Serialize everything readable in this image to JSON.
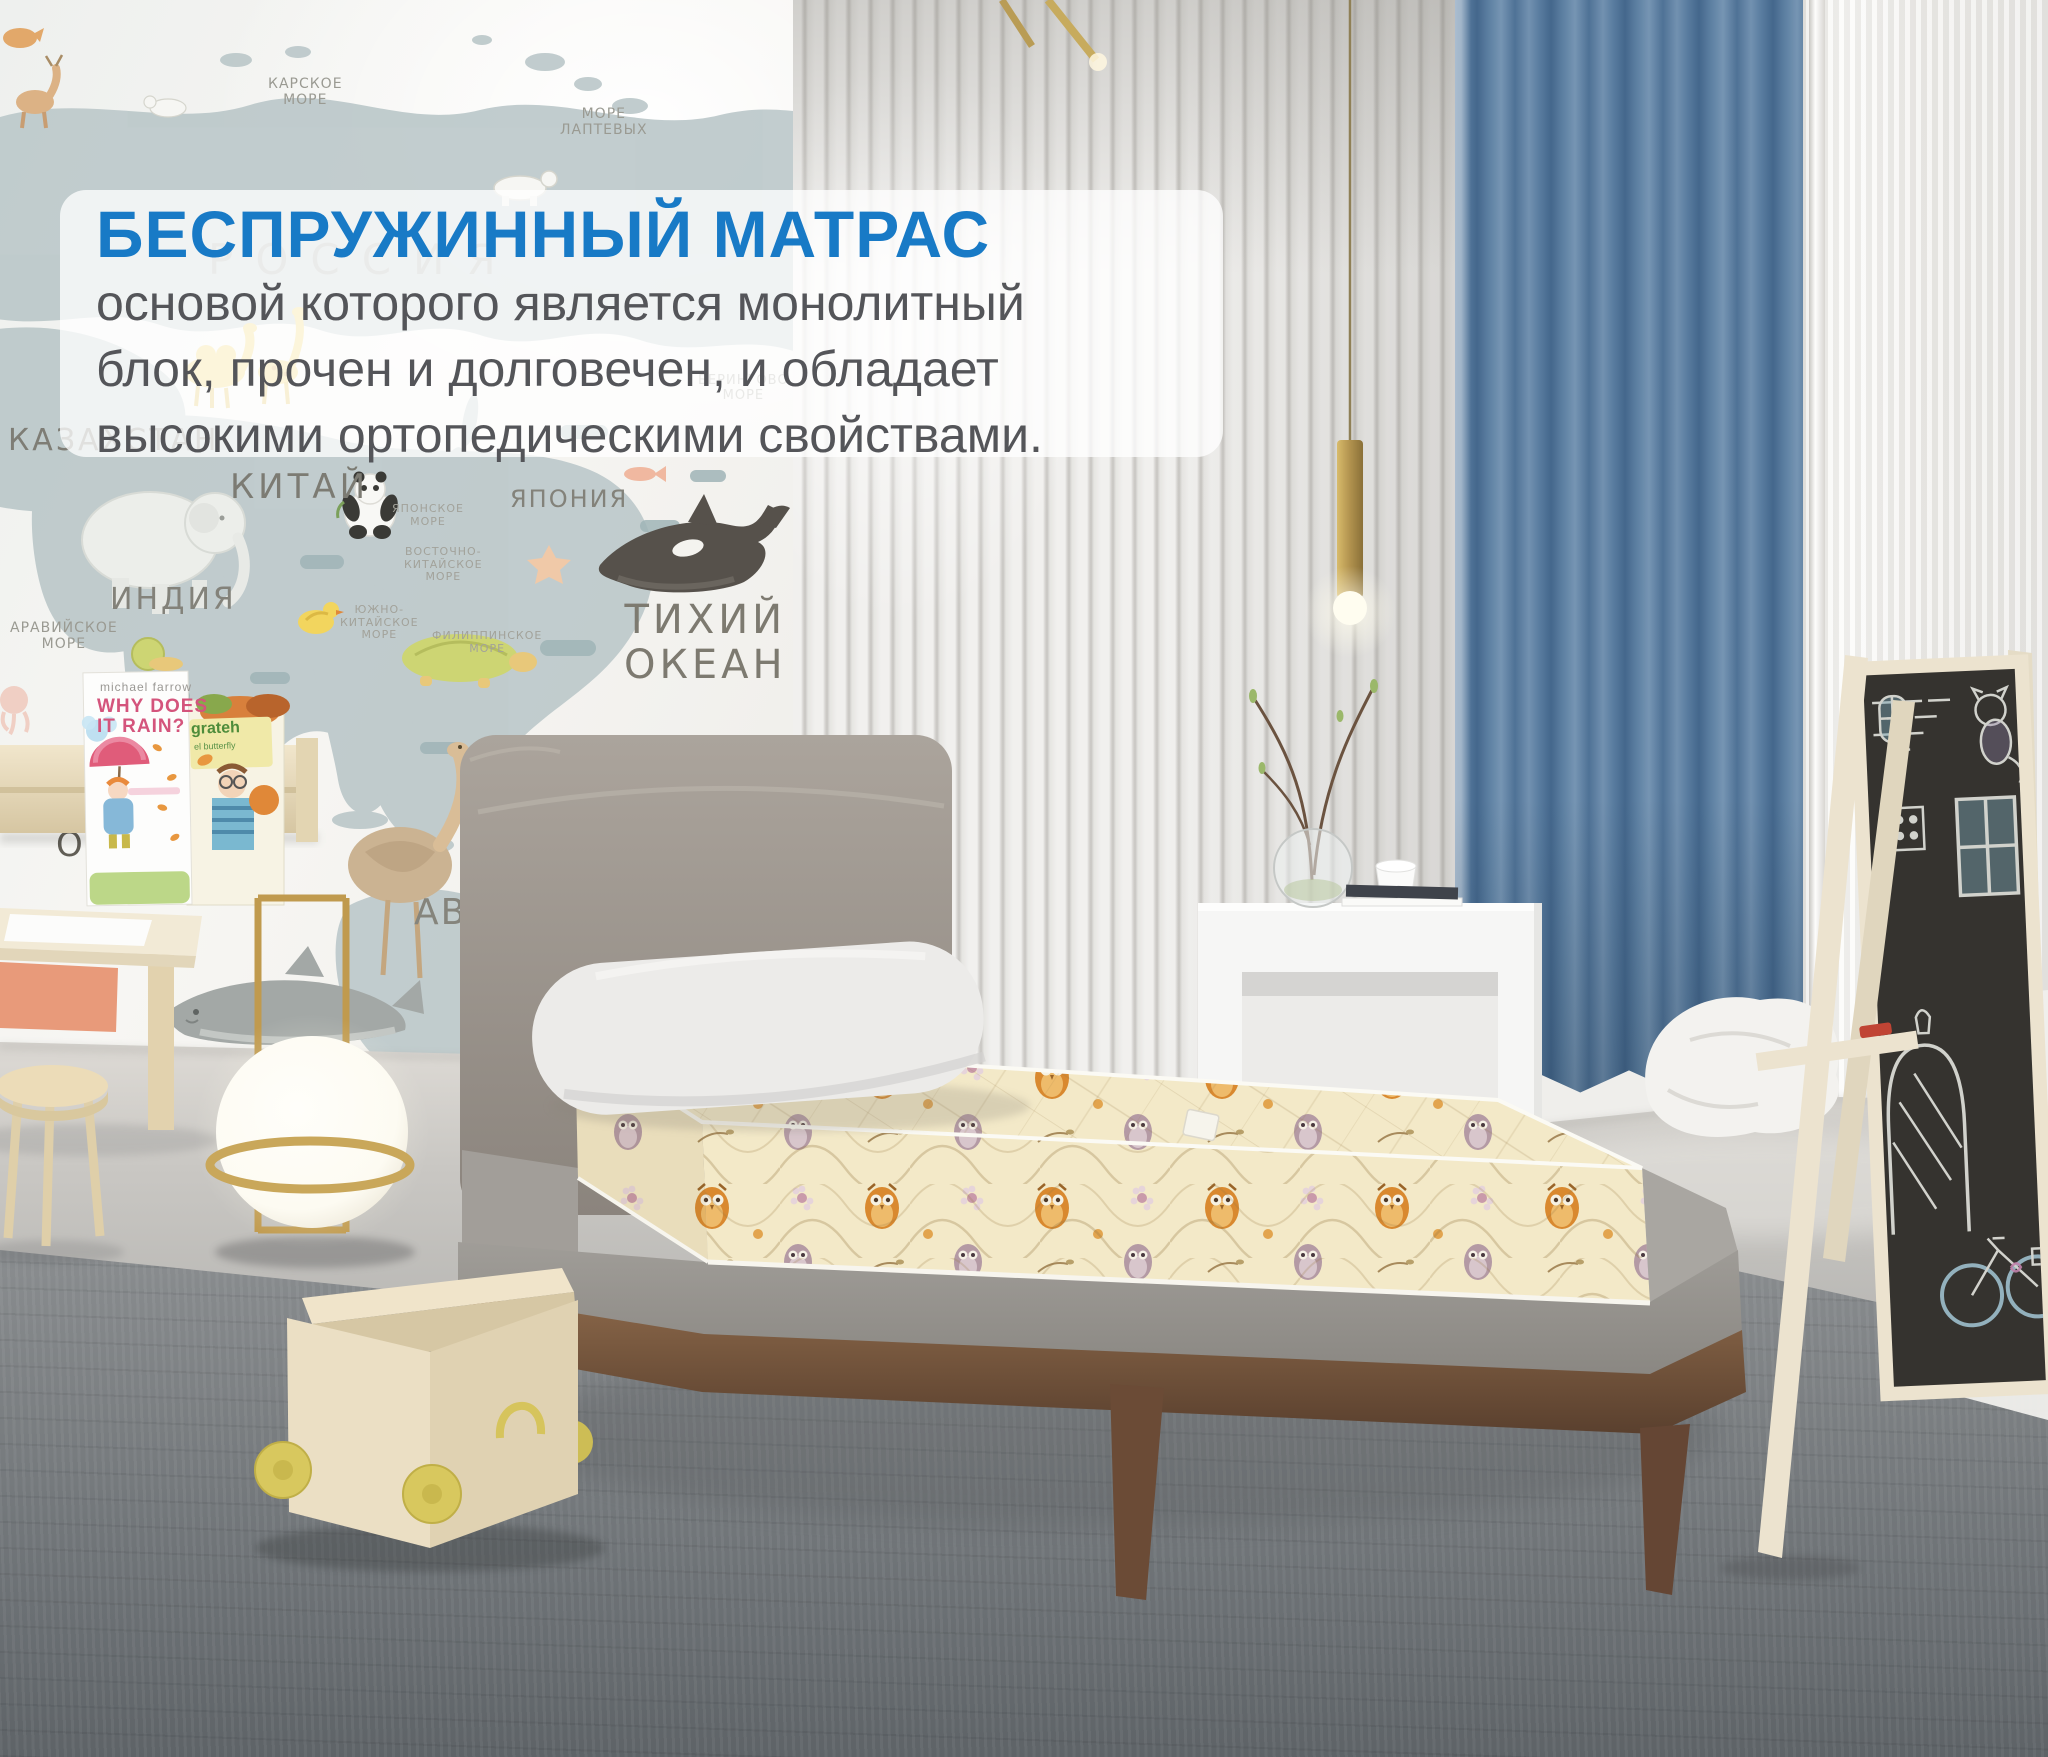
{
  "banner": {
    "title": "БЕСПРУЖИННЫЙ МАТРАС",
    "line1": "основой которого является монолитный",
    "line2": "блок, прочен и долговечен, и обладает",
    "line3": "высокими ортопедическими свойствами.",
    "title_color": "#187ac6",
    "text_color": "#545559",
    "background": "rgba(255,255,255,0.76)"
  },
  "map": {
    "labels": {
      "kara_sea": "КАРСКОЕ\nМОРЕ",
      "laptev_sea": "МОРЕ\nЛАПТЕВЫХ",
      "bering_sea": "БЕРИНГОВО\nМОРЕ",
      "russia": "РОССИЯ",
      "kazakhstan": "КАЗАХСТАН",
      "china": "КИТАЙ",
      "india": "ИНДИЯ",
      "japan": "ЯПОНИЯ",
      "japan_sea": "ЯПОНСКОЕ\nМОРЕ",
      "east_china_sea": "ВОСТОЧНО-\nКИТАЙСКОЕ\nМОРЕ",
      "south_china_sea": "ЮЖНО-\nКИТАЙСКОЕ\nМОРЕ",
      "philippine_sea": "ФИЛИППИНСКОЕ\nМОРЕ",
      "arabian_sea": "АРАВИЙСКОЕ\nМОРЕ",
      "pacific_ocean": "ТИХИЙ\nОКЕАН",
      "indian": "ИНДИЙСКИЙ",
      "ocean": "ОКЕАН",
      "australia": "АВСТРАЛИЯ"
    }
  },
  "books": {
    "book1_author": "michael farrow",
    "book1_title": "WHY DOES\nIT RAIN?",
    "book2_title": "grateh",
    "book2_subtitle": "el butterfly"
  },
  "colors": {
    "accent_blue": "#187ac6",
    "curtain_blue": "#5d80a2",
    "mattress_cream": "#f3e9c8",
    "owl_orange": "#d9892f",
    "bed_wood": "#6b4b36",
    "brass_gold": "#c9a75a",
    "carpet_gray": "#7a7e81",
    "wall_white": "#f4f3f0",
    "map_land": "#b9c6c8"
  }
}
